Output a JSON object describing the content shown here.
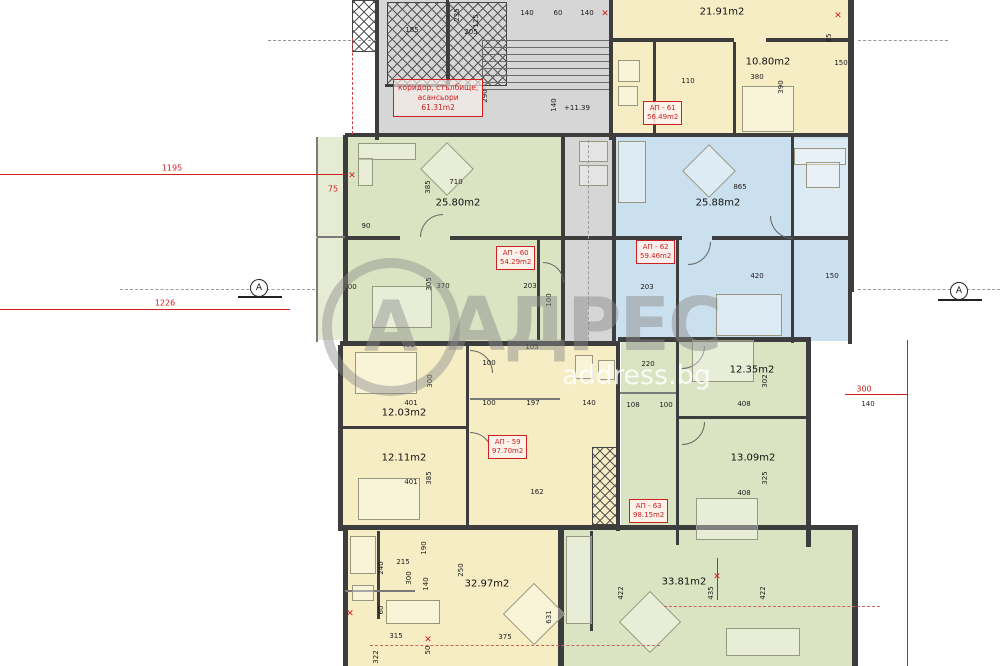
{
  "watermark": {
    "brand": "АДРЕС",
    "site": "address.bg",
    "logo_letter": "А"
  },
  "corridor_box": {
    "line1": "коридор, стълбище,",
    "line2": "асансьори",
    "line3": "61.31m2"
  },
  "elevation": {
    "t": "+11.39"
  },
  "colors": {
    "apartment_yellow": "#f6edc4",
    "apartment_green": "#dbe4c2",
    "apartment_blue": "#cbe0ee",
    "circulation_gray": "#d6d6d6",
    "annotation_red": "#cf2020"
  },
  "apartments": [
    {
      "id": "АП - 61",
      "area": "56.49m2",
      "x": 643,
      "y": 101
    },
    {
      "id": "АП - 60",
      "area": "54.29m2",
      "x": 496,
      "y": 246
    },
    {
      "id": "АП - 62",
      "area": "59.46m2",
      "x": 636,
      "y": 240
    },
    {
      "id": "АП - 59",
      "area": "97.70m2",
      "x": 488,
      "y": 435
    },
    {
      "id": "АП - 63",
      "area": "98.15m2",
      "x": 629,
      "y": 499
    }
  ],
  "rooms": [
    {
      "label": "21.91m2",
      "x": 722,
      "y": 12
    },
    {
      "label": "10.80m2",
      "x": 768,
      "y": 62
    },
    {
      "label": "25.80m2",
      "x": 458,
      "y": 203
    },
    {
      "label": "25.88m2",
      "x": 718,
      "y": 203
    },
    {
      "label": "12.03m2",
      "x": 404,
      "y": 413
    },
    {
      "label": "12.11m2",
      "x": 404,
      "y": 458
    },
    {
      "label": "12.35m2",
      "x": 752,
      "y": 370
    },
    {
      "label": "13.09m2",
      "x": 753,
      "y": 458
    },
    {
      "label": "32.97m2",
      "x": 487,
      "y": 584
    },
    {
      "label": "33.81m2",
      "x": 684,
      "y": 582
    }
  ],
  "dims": [
    {
      "t": "185",
      "x": 412,
      "y": 30
    },
    {
      "t": "235",
      "x": 457,
      "y": 15,
      "v": 1
    },
    {
      "t": "125",
      "x": 476,
      "y": 21,
      "v": 1
    },
    {
      "t": "205",
      "x": 471,
      "y": 32
    },
    {
      "t": "140",
      "x": 527,
      "y": 13
    },
    {
      "t": "60",
      "x": 558,
      "y": 13
    },
    {
      "t": "140",
      "x": 587,
      "y": 13
    },
    {
      "t": "290",
      "x": 485,
      "y": 96,
      "v": 1
    },
    {
      "t": "140",
      "x": 554,
      "y": 105,
      "v": 1
    },
    {
      "t": "110",
      "x": 688,
      "y": 81
    },
    {
      "t": "380",
      "x": 757,
      "y": 77
    },
    {
      "t": "390",
      "x": 781,
      "y": 87,
      "v": 1
    },
    {
      "t": "85",
      "x": 829,
      "y": 38,
      "v": 1
    },
    {
      "t": "150",
      "x": 841,
      "y": 63
    },
    {
      "t": "385",
      "x": 428,
      "y": 187,
      "v": 1
    },
    {
      "t": "710",
      "x": 456,
      "y": 182
    },
    {
      "t": "90",
      "x": 366,
      "y": 226
    },
    {
      "t": "865",
      "x": 740,
      "y": 187
    },
    {
      "t": "200",
      "x": 350,
      "y": 287
    },
    {
      "t": "305",
      "x": 429,
      "y": 284,
      "v": 1
    },
    {
      "t": "370",
      "x": 443,
      "y": 286
    },
    {
      "t": "203",
      "x": 530,
      "y": 286
    },
    {
      "t": "100",
      "x": 549,
      "y": 300,
      "v": 1
    },
    {
      "t": "203",
      "x": 647,
      "y": 287
    },
    {
      "t": "420",
      "x": 757,
      "y": 276
    },
    {
      "t": "150",
      "x": 832,
      "y": 276
    },
    {
      "t": "401",
      "x": 408,
      "y": 345
    },
    {
      "t": "105",
      "x": 532,
      "y": 347
    },
    {
      "t": "300",
      "x": 430,
      "y": 381,
      "v": 1
    },
    {
      "t": "100",
      "x": 489,
      "y": 363
    },
    {
      "t": "401",
      "x": 411,
      "y": 403
    },
    {
      "t": "100",
      "x": 489,
      "y": 403
    },
    {
      "t": "197",
      "x": 533,
      "y": 403
    },
    {
      "t": "140",
      "x": 589,
      "y": 403
    },
    {
      "t": "401",
      "x": 411,
      "y": 482
    },
    {
      "t": "385",
      "x": 429,
      "y": 478,
      "v": 1
    },
    {
      "t": "162",
      "x": 537,
      "y": 492
    },
    {
      "t": "220",
      "x": 648,
      "y": 364
    },
    {
      "t": "108",
      "x": 633,
      "y": 405
    },
    {
      "t": "100",
      "x": 666,
      "y": 405
    },
    {
      "t": "408",
      "x": 744,
      "y": 404
    },
    {
      "t": "302",
      "x": 765,
      "y": 381,
      "v": 1
    },
    {
      "t": "408",
      "x": 744,
      "y": 493
    },
    {
      "t": "325",
      "x": 765,
      "y": 478,
      "v": 1
    },
    {
      "t": "140",
      "x": 868,
      "y": 404
    },
    {
      "t": "190",
      "x": 424,
      "y": 548,
      "v": 1
    },
    {
      "t": "240",
      "x": 381,
      "y": 568,
      "v": 1
    },
    {
      "t": "215",
      "x": 403,
      "y": 562
    },
    {
      "t": "300",
      "x": 409,
      "y": 578,
      "v": 1
    },
    {
      "t": "140",
      "x": 426,
      "y": 584,
      "v": 1
    },
    {
      "t": "250",
      "x": 461,
      "y": 570,
      "v": 1
    },
    {
      "t": "60",
      "x": 381,
      "y": 610,
      "v": 1
    },
    {
      "t": "315",
      "x": 396,
      "y": 636
    },
    {
      "t": "50",
      "x": 428,
      "y": 650,
      "v": 1
    },
    {
      "t": "375",
      "x": 505,
      "y": 637
    },
    {
      "t": "631",
      "x": 549,
      "y": 617,
      "v": 1
    },
    {
      "t": "322",
      "x": 376,
      "y": 657,
      "v": 1
    },
    {
      "t": "422",
      "x": 621,
      "y": 593,
      "v": 1
    },
    {
      "t": "435",
      "x": 711,
      "y": 593,
      "v": 1
    },
    {
      "t": "422",
      "x": 763,
      "y": 593,
      "v": 1
    }
  ],
  "red_dims": [
    {
      "t": "1195",
      "x": 172,
      "y": 168
    },
    {
      "t": "1226",
      "x": 165,
      "y": 303
    },
    {
      "t": "75",
      "x": 333,
      "y": 189
    },
    {
      "t": "300",
      "x": 864,
      "y": 389
    }
  ],
  "red_marks": [
    {
      "x": 352,
      "y": 176
    },
    {
      "x": 350,
      "y": 614
    },
    {
      "x": 428,
      "y": 640
    },
    {
      "x": 717,
      "y": 577
    },
    {
      "x": 605,
      "y": 14
    },
    {
      "x": 838,
      "y": 16
    }
  ],
  "section_markers": [
    {
      "letter": "А",
      "x": 250,
      "y": 279
    },
    {
      "letter": "А",
      "x": 950,
      "y": 282
    }
  ],
  "icons": {
    "red_mark_glyph": "✕"
  }
}
